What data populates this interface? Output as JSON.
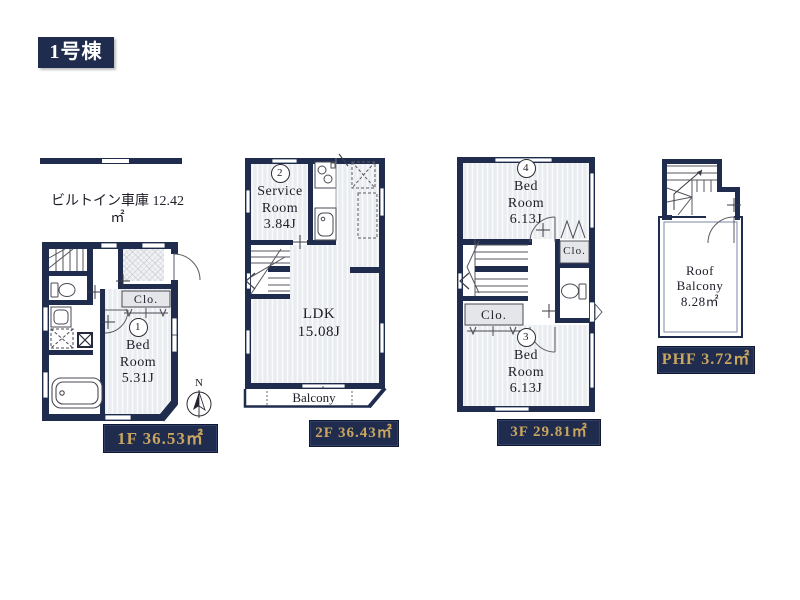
{
  "colors": {
    "navy": "#1f2c4d",
    "gold": "#c9a55f",
    "floor_fill": "#eaedf0",
    "closet_fill": "#e4e6e9"
  },
  "header": {
    "building_label": "1号棟"
  },
  "floor1": {
    "garage_name": "ビルトイン車庫",
    "garage_area": "12.42㎡",
    "closet_label": "Clo.",
    "room_number": "1",
    "room_name_line1": "Bed",
    "room_name_line2": "Room",
    "room_size": "5.31J",
    "compass_label": "N",
    "floor_label": "1F 36.53㎡"
  },
  "floor2": {
    "room_number": "2",
    "room_name_line1": "Service",
    "room_name_line2": "Room",
    "room_size": "3.84J",
    "ldk_name": "LDK",
    "ldk_size": "15.08J",
    "balcony_label": "Balcony",
    "floor_label": "2F 36.43㎡"
  },
  "floor3": {
    "room4_number": "4",
    "room4_name_line1": "Bed",
    "room4_name_line2": "Room",
    "room4_size": "6.13J",
    "closet_right_label": "Clo.",
    "closet_left_label": "Clo.",
    "room3_number": "3",
    "room3_name_line1": "Bed",
    "room3_name_line2": "Room",
    "room3_size": "6.13J",
    "floor_label": "3F 29.81㎡"
  },
  "phf": {
    "balcony_name_line1": "Roof",
    "balcony_name_line2": "Balcony",
    "balcony_area": "8.28㎡",
    "floor_label": "PHF 3.72㎡"
  }
}
